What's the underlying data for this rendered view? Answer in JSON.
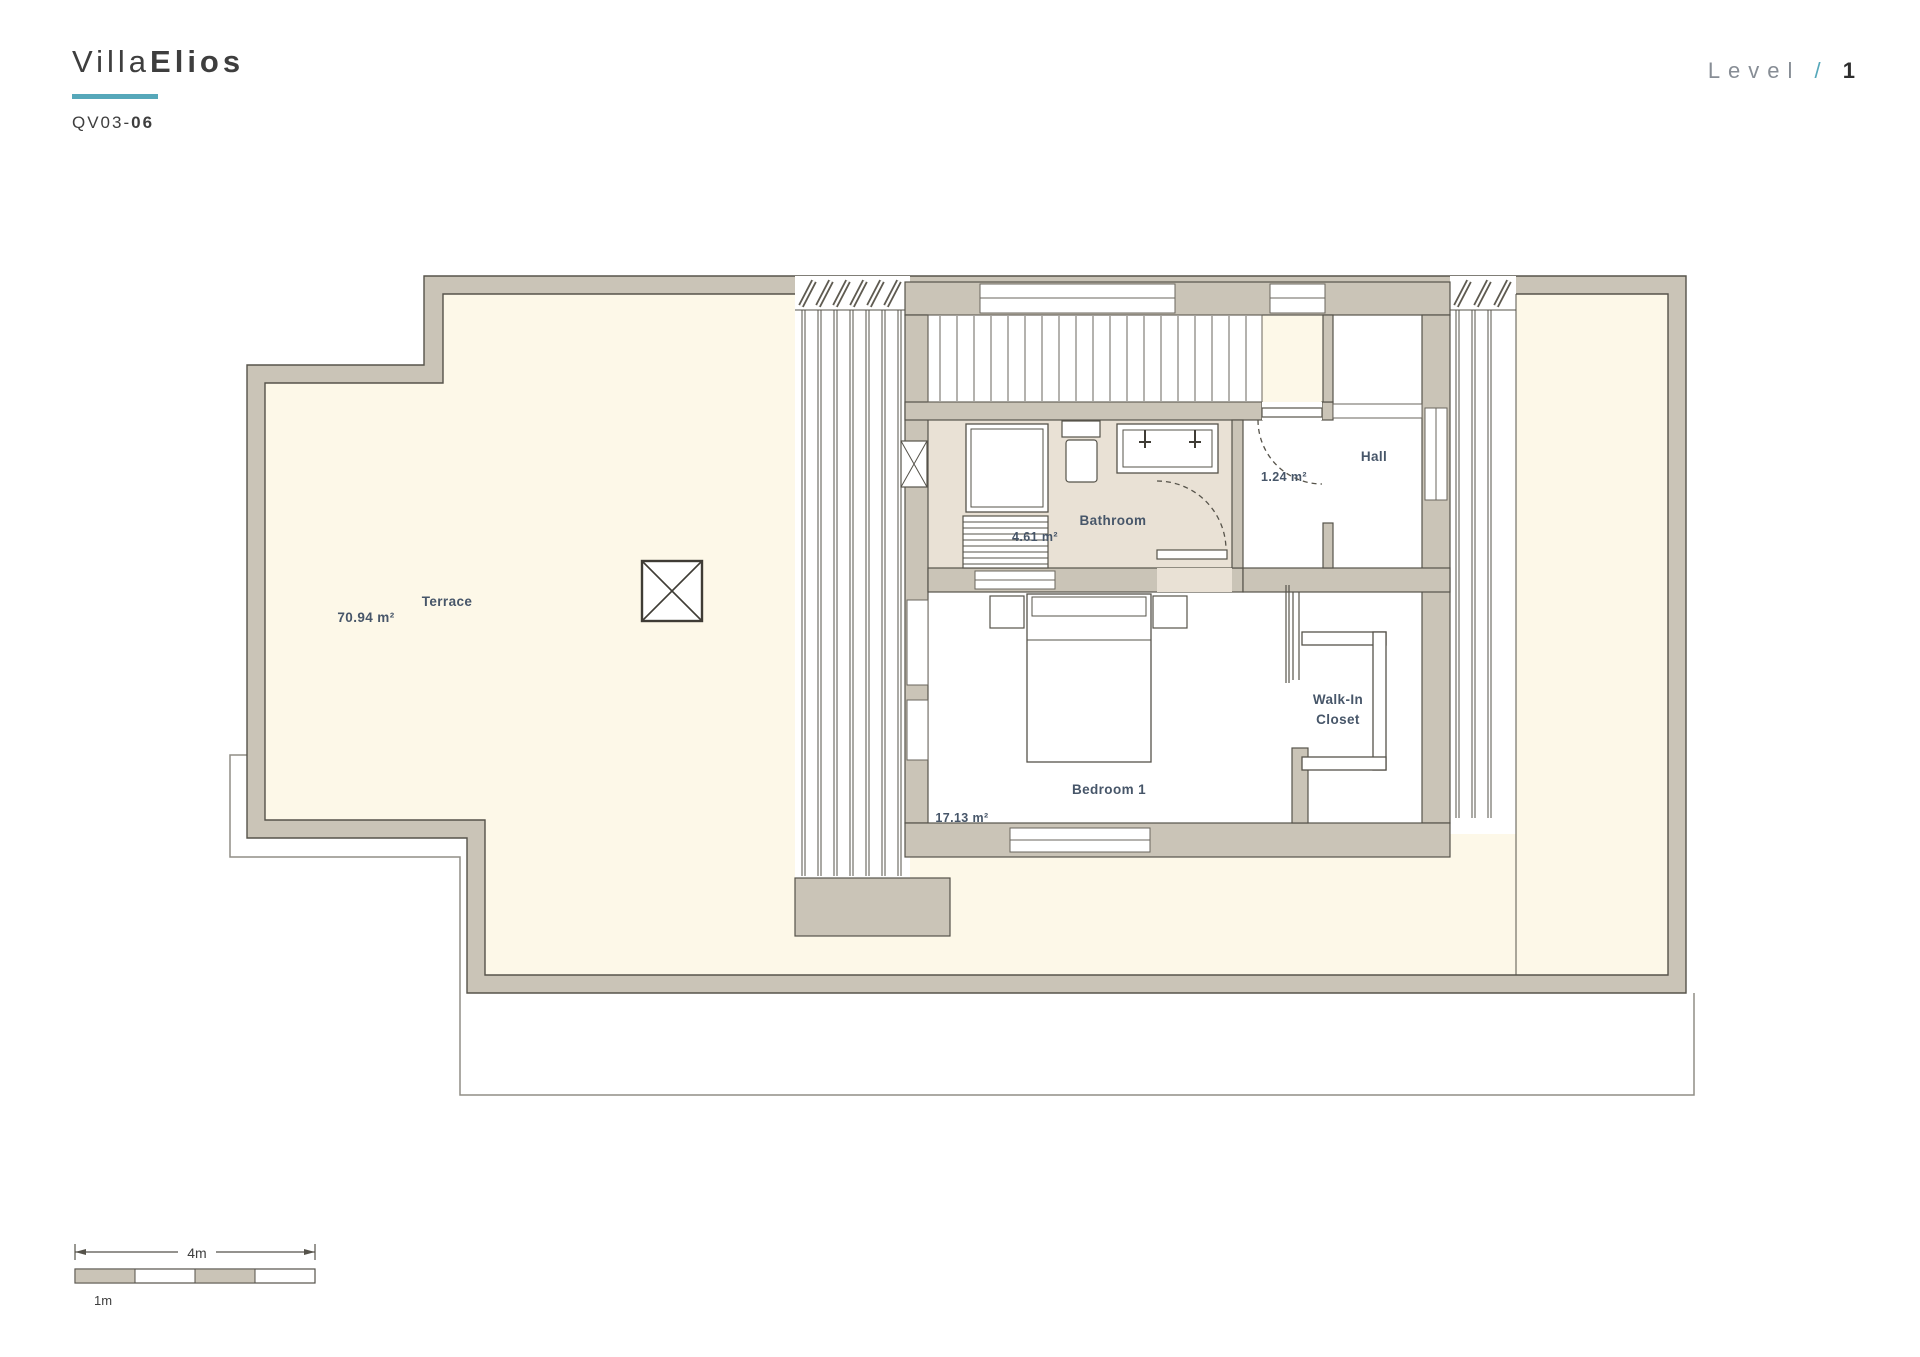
{
  "header": {
    "title_light": "Villa",
    "title_bold": "Elios",
    "code_light": "QV03-",
    "code_bold": "06"
  },
  "level": {
    "label": "Level",
    "separator": "/",
    "value": "1"
  },
  "rooms": {
    "terrace": {
      "name": "Terrace",
      "area": "70.94 m²"
    },
    "bathroom": {
      "name": "Bathroom",
      "area": "4.61 m²"
    },
    "hall": {
      "name": "Hall",
      "area": "1.24 m²"
    },
    "bedroom": {
      "name": "Bedroom 1",
      "area": "17.13 m²"
    },
    "closet": {
      "name_line1": "Walk-In",
      "name_line2": "Closet"
    }
  },
  "scale_bar": {
    "total": "4m",
    "unit": "1m"
  },
  "colors": {
    "accent": "#56a8ba",
    "wall_fill": "#cac4b7",
    "wall_line": "#56534a",
    "terrace_floor": "#fdf8e8",
    "bathroom_floor": "#e9e1d5",
    "label_text": "#475669"
  }
}
